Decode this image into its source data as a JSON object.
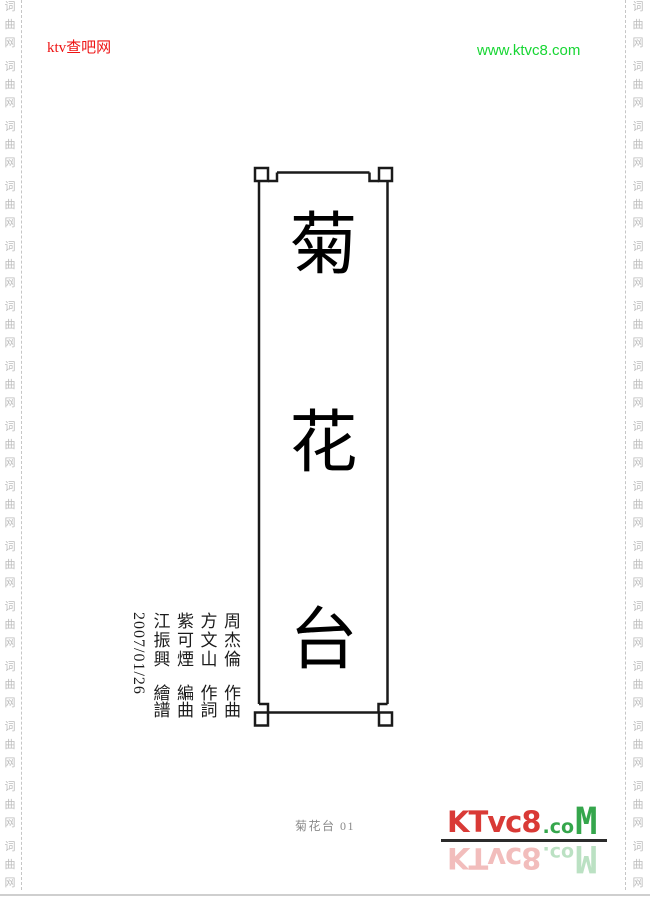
{
  "header": {
    "left_brand": "ktv查吧网",
    "left_brand_color": "#ee1313",
    "right_url": "www.ktvc8.com",
    "right_url_color": "#17d633"
  },
  "rails": {
    "chars": [
      "词",
      "曲",
      "网"
    ],
    "repeat": 15,
    "color": "#bcbcbc"
  },
  "title": {
    "chars": [
      "菊",
      "花",
      "台"
    ],
    "frame_color": "#1a1a1a"
  },
  "credits": {
    "columns": [
      {
        "name": "周杰倫",
        "role": "作曲"
      },
      {
        "name": "方文山",
        "role": "作詞"
      },
      {
        "name": "紫可煙",
        "role": "編曲"
      },
      {
        "name": "江振興",
        "role": "繪譜"
      }
    ],
    "date": "2007/01/26"
  },
  "footer": {
    "page_label": "菊花台 01",
    "logo": {
      "part1": "KTvc8",
      "part2": ".co",
      "part3": "M",
      "red": "#d93a36",
      "green": "#35a64c"
    }
  }
}
